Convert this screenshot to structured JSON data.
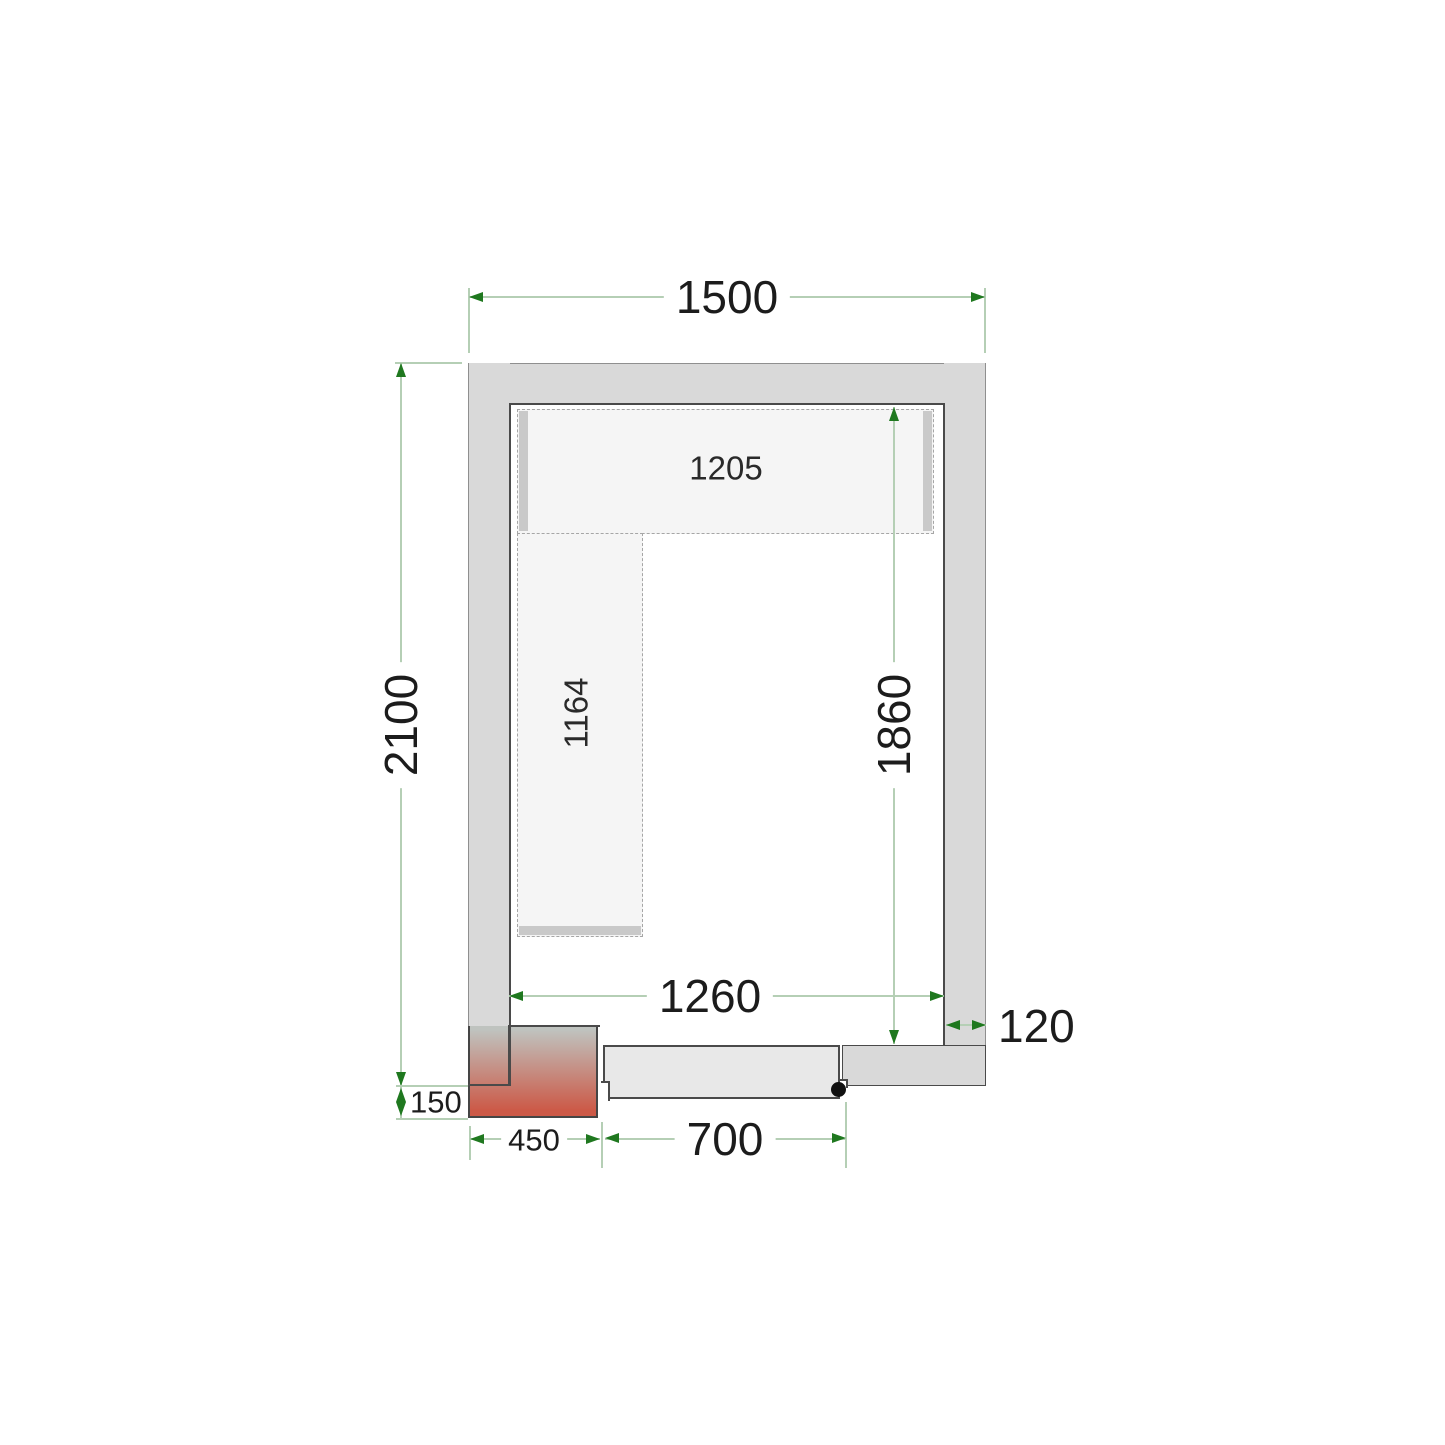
{
  "dims": {
    "outer_width": "1500",
    "outer_depth": "2100",
    "inner_width": "1260",
    "inner_depth": "1860",
    "wall_thickness": "120",
    "door_width": "700",
    "heated_frame_width": "450",
    "frame_protrusion": "150",
    "top_shelf_length": "1205",
    "side_shelf_length": "1164"
  },
  "colors": {
    "background": "#ffffff",
    "wall": "#d9d9d9",
    "outline_dark": "#4a4a4a",
    "outline_light": "#8f8f8f",
    "shelf": "#f5f5f5",
    "shelf_edge": "#c9c9c9",
    "door": "#e8e8e8",
    "pivot_dot": "#111111",
    "heater_top": "#bfc3bf",
    "heater_red": "#cc5947",
    "dim_line": "#b5cfb5",
    "dim_arrow": "#1f781f",
    "text": "#1c1c1c"
  }
}
